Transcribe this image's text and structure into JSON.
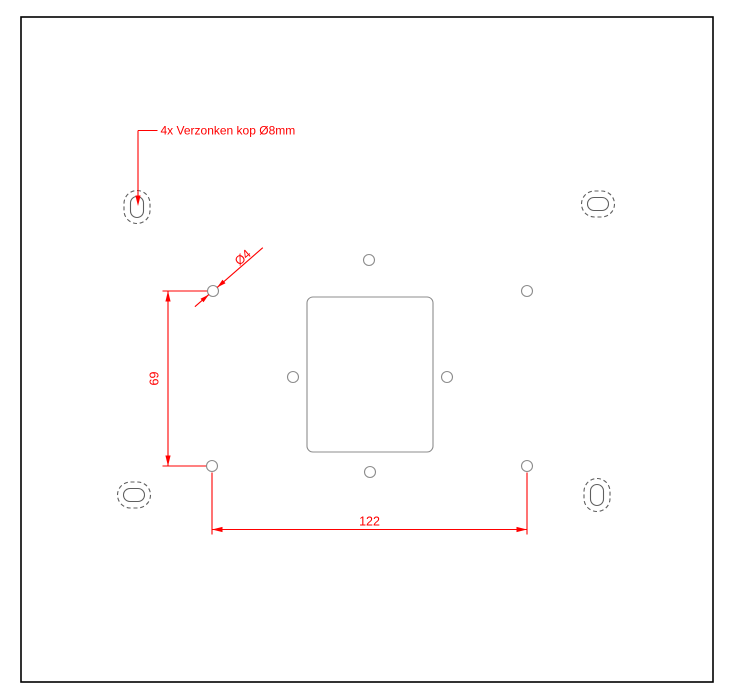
{
  "drawing": {
    "annotation": {
      "label": "4x Verzonken kop Ø8mm"
    },
    "dimensions": {
      "vertical_value": "69",
      "horizontal_value": "122",
      "diameter_label": "Ø4"
    },
    "colors": {
      "dimension_red": "#ff0000",
      "geometry_gray": "#8c8c8c",
      "slot_gray": "#5f5f5f",
      "border_black": "#000000",
      "background": "#ffffff"
    }
  }
}
